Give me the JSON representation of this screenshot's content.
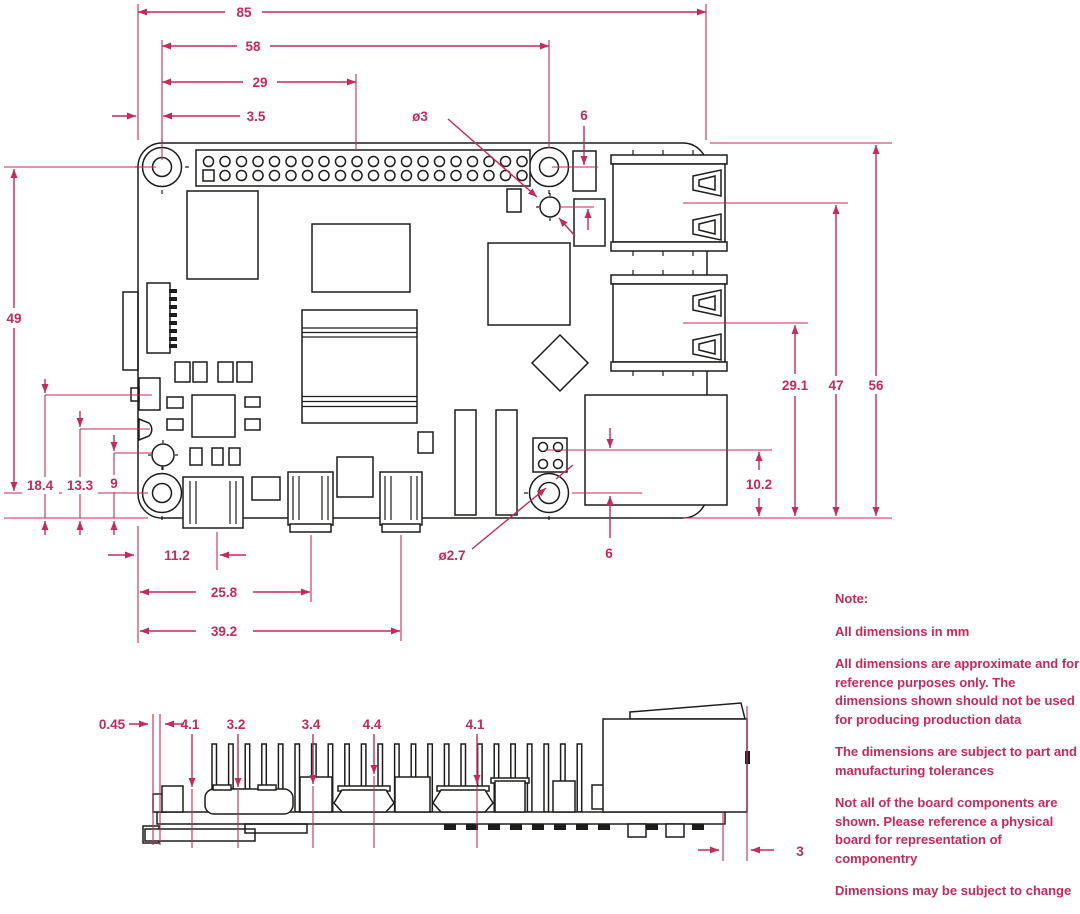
{
  "colors": {
    "accent": "#c7295a",
    "ink": "#1d1d1b"
  },
  "dims": {
    "board_width": "85",
    "hole_span_h": "58",
    "gpio_center": "29",
    "hole_inset": "3.5",
    "hole_dia_top": "ø3",
    "hole_offset_top": "6",
    "usb2_center": "29.1",
    "usb1_center": "47",
    "board_height": "56",
    "eth_center": "10.2",
    "hole_offset_bottom": "6",
    "hole_span_v": "49",
    "conn1_y": "18.4",
    "conn2_y": "13.3",
    "conn3_y": "9",
    "usbc_center": "11.2",
    "hdmi1_center": "25.8",
    "hdmi2_center": "39.2",
    "hole_dia_bottom": "ø2.7",
    "side": {
      "sd_offset": "0.45",
      "h1": "4.1",
      "h2": "3.2",
      "h3": "3.4",
      "h4": "4.4",
      "h5": "4.1",
      "usb_overhang": "3"
    }
  },
  "note": {
    "title": "Note:",
    "paragraphs": [
      "All dimensions in mm",
      "All dimensions are approximate and for reference purposes only. The dimensions shown should not be used for producing production data",
      "The dimensions are subject to part and manufacturing tolerances",
      "Not all of the board components are shown. Please reference a physical board for representation of componentry",
      "Dimensions may be subject to change"
    ]
  }
}
